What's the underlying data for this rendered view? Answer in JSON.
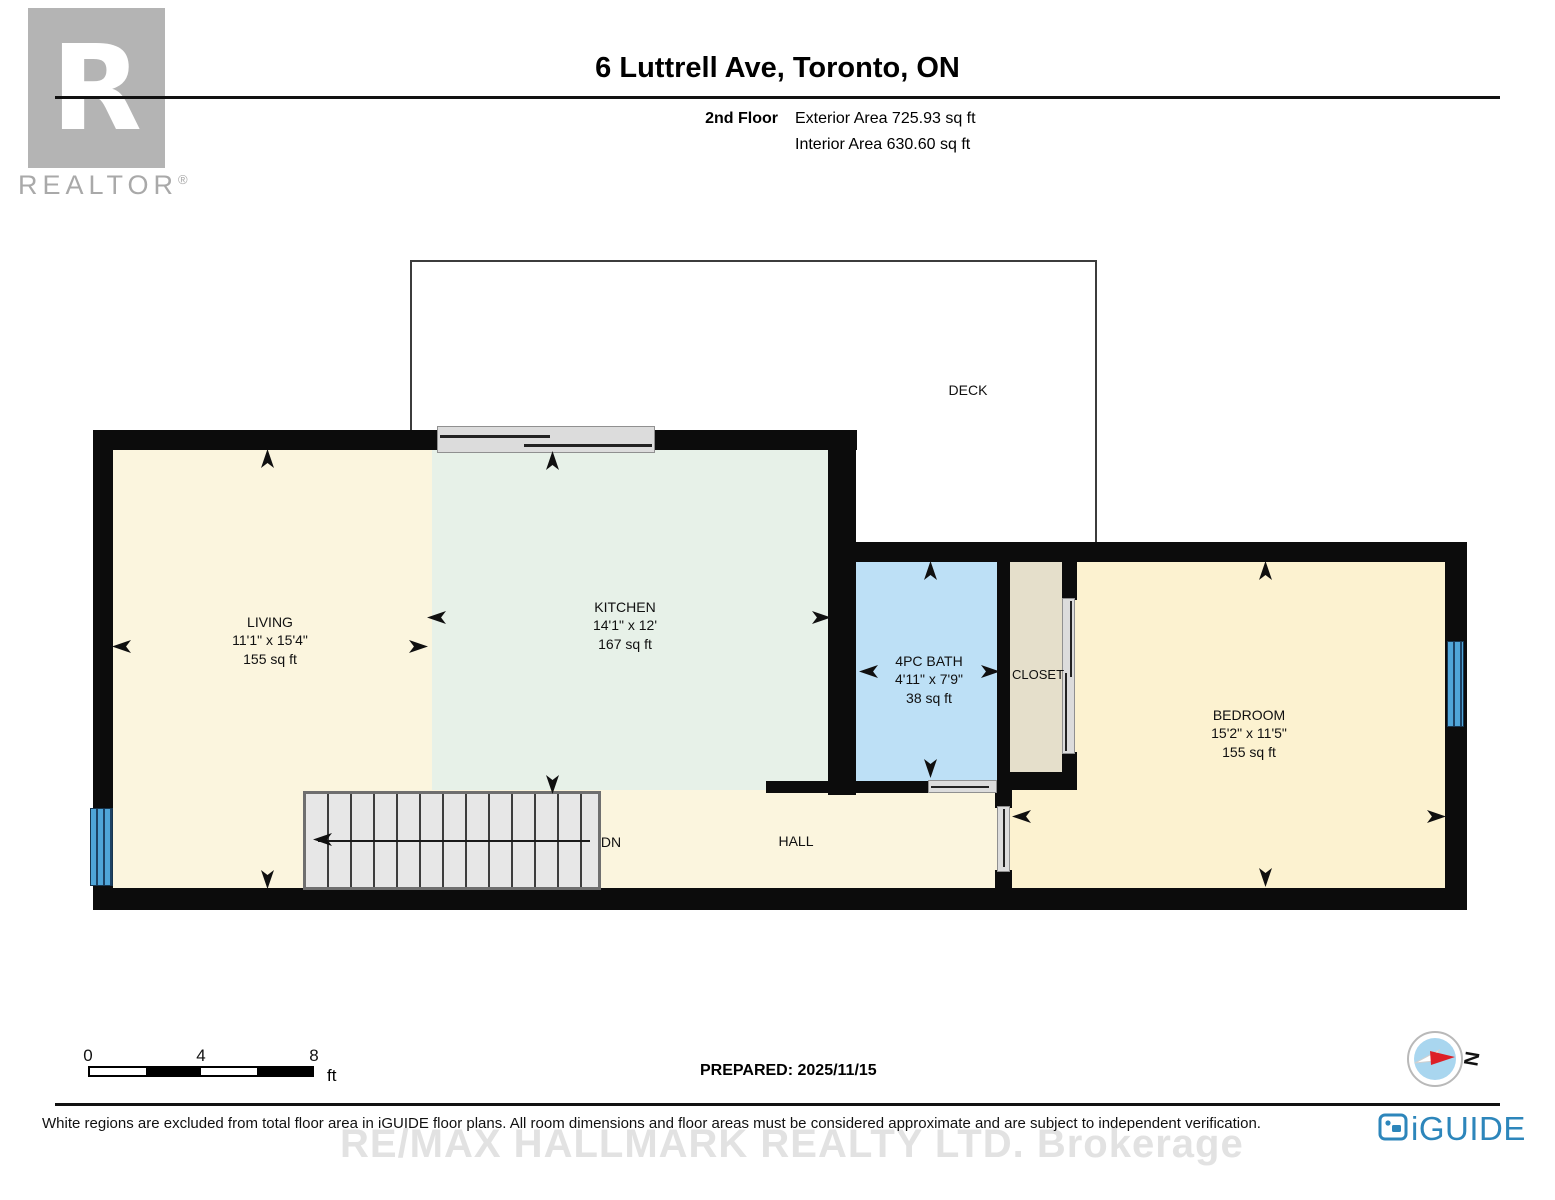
{
  "header": {
    "title": "6 Luttrell Ave, Toronto, ON",
    "floor_label": "2nd Floor",
    "exterior_area": "Exterior Area 725.93 sq ft",
    "interior_area": "Interior Area 630.60 sq ft"
  },
  "branding": {
    "realtor_letter": "R",
    "realtor_text": "REALTOR",
    "registered_mark": "®",
    "iguide_text": "iGUIDE",
    "watermark": "RE/MAX HALLMARK REALTY LTD.  Brokerage"
  },
  "rooms": {
    "living": {
      "name": "LIVING",
      "dims": "11'1\" x 15'4\"",
      "area": "155 sq ft"
    },
    "kitchen": {
      "name": "KITCHEN",
      "dims": "14'1\" x 12'",
      "area": "167 sq ft"
    },
    "bath": {
      "name": "4PC BATH",
      "dims": "4'11\" x 7'9\"",
      "area": "38 sq ft"
    },
    "closet": {
      "name": "CLOSET"
    },
    "bedroom": {
      "name": "BEDROOM",
      "dims": "15'2\" x 11'5\"",
      "area": "155 sq ft"
    },
    "hall": {
      "name": "HALL"
    },
    "deck": {
      "name": "DECK"
    }
  },
  "stairs": {
    "label": "DN"
  },
  "scale_bar": {
    "tick_0": "0",
    "tick_mid": "4",
    "tick_end": "8",
    "unit": "ft"
  },
  "prepared_label": "PREPARED: 2025/11/15",
  "compass": {
    "north_label": "N"
  },
  "footer": {
    "disclaimer": "White regions are excluded from total floor area in iGUIDE floor plans. All room dimensions and floor areas must be considered approximate and are subject to independent verification."
  },
  "colors": {
    "wall": "#0c0c0c",
    "living_fill": "#FBF5DE",
    "kitchen_fill": "#E7F1E8",
    "bath_fill": "#BDE0F6",
    "closet_fill": "#E5DFCB",
    "bedroom_fill": "#FCF2D0",
    "window_blue": "#4FA5D8",
    "stairs_gray": "#E7E7E7",
    "door_gray": "#DCDCDC",
    "iguide_blue": "#2D86BB",
    "compass_red": "#DD1F26",
    "realtor_gray": "#B4B4B4"
  }
}
